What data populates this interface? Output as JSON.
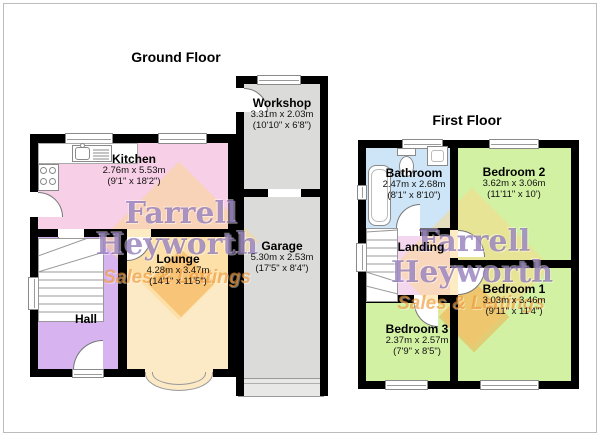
{
  "titles": {
    "ground": "Ground Floor",
    "first": "First Floor"
  },
  "watermark": {
    "line1": "Farrell",
    "line2": "Heyworth",
    "line3": "Sales & Lettings",
    "text_color": "#7658a8",
    "tagline_color": "#ee922a",
    "logo_color": "#fbd88a"
  },
  "colors": {
    "wall": "#000000",
    "kitchen": "#f7cfe6",
    "hall": "#d7b3ef",
    "lounge": "#fce9c5",
    "workshop_garage": "#dbdbd9",
    "bathroom": "#cde5f6",
    "bedroom": "#d2f1a3",
    "landing": "#f4d7ee"
  },
  "ground_floor": {
    "title": "Ground Floor",
    "rooms": {
      "kitchen": {
        "name": "Kitchen",
        "dims_m": "2.76m x 5.53m",
        "dims_ft": "(9'1\" x 18'2\")"
      },
      "workshop": {
        "name": "Workshop",
        "dims_m": "3.31m x 2.03m",
        "dims_ft": "(10'10\" x 6'8\")"
      },
      "garage": {
        "name": "Garage",
        "dims_m": "5.30m x 2.53m",
        "dims_ft": "(17'5\" x 8'4\")"
      },
      "lounge": {
        "name": "Lounge",
        "dims_m": "4.28m x 3.47m",
        "dims_ft": "(14'1\" x 11'5\")"
      },
      "hall": {
        "name": "Hall"
      }
    }
  },
  "first_floor": {
    "title": "First Floor",
    "rooms": {
      "bathroom": {
        "name": "Bathroom",
        "dims_m": "2.47m x 2.68m",
        "dims_ft": "(8'1\" x 8'10\")"
      },
      "bedroom2": {
        "name": "Bedroom 2",
        "dims_m": "3.62m x 3.06m",
        "dims_ft": "(11'11\" x 10')"
      },
      "landing": {
        "name": "Landing"
      },
      "bedroom1": {
        "name": "Bedroom 1",
        "dims_m": "3.03m x 3.46m",
        "dims_ft": "(9'11\" x 11'4\")"
      },
      "bedroom3": {
        "name": "Bedroom 3",
        "dims_m": "2.37m x 2.57m",
        "dims_ft": "(7'9\" x 8'5\")"
      }
    }
  }
}
